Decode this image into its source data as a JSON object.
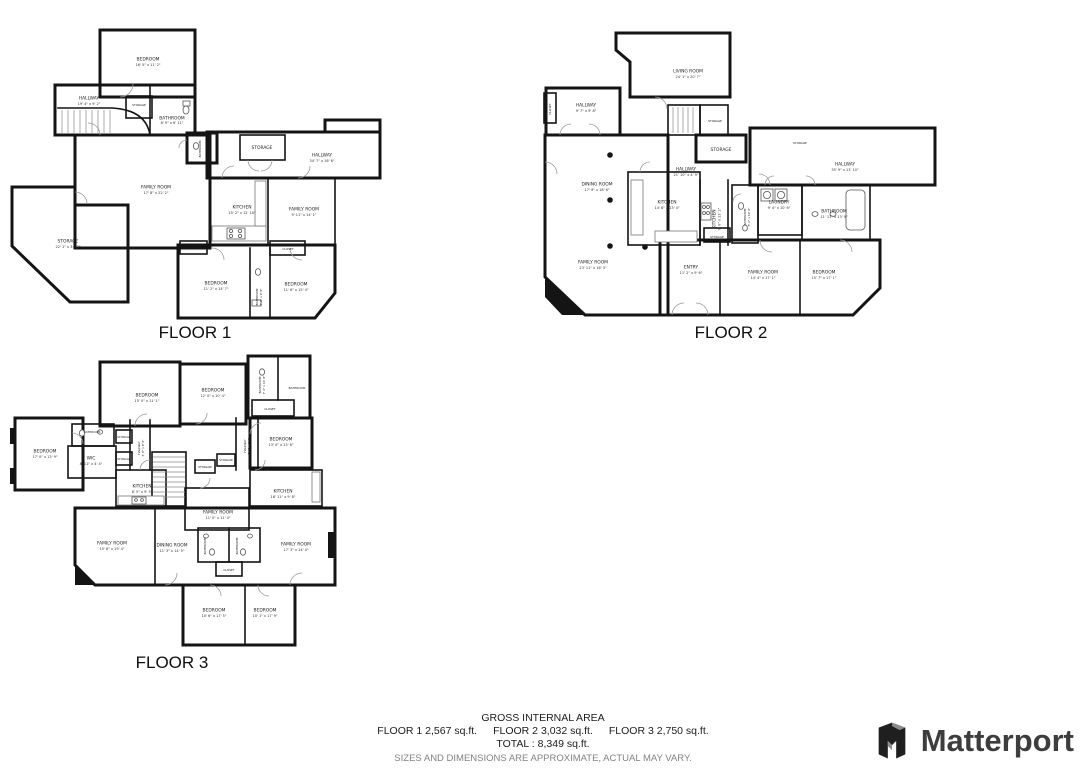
{
  "colors": {
    "walls": "#141414",
    "label_text": "#1d1d1d",
    "disclaimer_gray": "#828282",
    "logo_gray": "#3d3d3d"
  },
  "floors": [
    {
      "label": "FLOOR 1",
      "rooms": [
        {
          "name": "BEDROOM",
          "dims": "16' 5\" x 11' 2\""
        },
        {
          "name": "HALLWAY",
          "dims": "19' 4\" x 9' 2\""
        },
        {
          "name": "STORAGE",
          "dims": ""
        },
        {
          "name": "BATHROOM",
          "dims": "8' 9\" x 6' 11\""
        },
        {
          "name": "BATHROOM",
          "dims": ""
        },
        {
          "name": "STORAGE",
          "dims": ""
        },
        {
          "name": "HALLWAY",
          "dims": "34' 7\" x 16' 6\""
        },
        {
          "name": "FAMILY ROOM",
          "dims": "17' 8\" x 22' 2\""
        },
        {
          "name": "KITCHEN",
          "dims": "15' 2\" x 12' 10\""
        },
        {
          "name": "FAMILY ROOM",
          "dims": "9' 11\" x 14' 1\""
        },
        {
          "name": "STORAGE",
          "dims": "22' 1\" x 34' 3\""
        },
        {
          "name": "CLOSET",
          "dims": ""
        },
        {
          "name": "CLOSET",
          "dims": ""
        },
        {
          "name": "BEDROOM",
          "dims": "11' 2\" x 14' 7\""
        },
        {
          "name": "BATHROOM",
          "dims": "4' 2\" x 9' 9\""
        },
        {
          "name": "BEDROOM",
          "dims": "11' 6\" x 15' 4\""
        }
      ]
    },
    {
      "label": "FLOOR 2",
      "rooms": [
        {
          "name": "LIVING ROOM",
          "dims": "24' 1\" x 20' 7\""
        },
        {
          "name": "HALLWAY",
          "dims": "9' 7\" x 9' 8\""
        },
        {
          "name": "CLOSET",
          "dims": ""
        },
        {
          "name": "STORAGE",
          "dims": ""
        },
        {
          "name": "STORAGE",
          "dims": ""
        },
        {
          "name": "STORAGE",
          "dims": ""
        },
        {
          "name": "HALLWAY",
          "dims": "21' 10\" x 4' 9\""
        },
        {
          "name": "HALLWAY",
          "dims": "35' 9\" x 13' 10\""
        },
        {
          "name": "DINING ROOM",
          "dims": "17' 9\" x 18' 6\""
        },
        {
          "name": "KITCHEN",
          "dims": "14' 8\" x 13' 4\""
        },
        {
          "name": "KITCHEN",
          "dims": "7' 0\" x 13' 2\""
        },
        {
          "name": "BATHROOM",
          "dims": "5' 2\" x 10' 6\""
        },
        {
          "name": "LAUNDRY",
          "dims": "9' 4\" x 10' 6\""
        },
        {
          "name": "BATHROOM",
          "dims": "11' 11\" x 13' 9\""
        },
        {
          "name": "FAMILY ROOM",
          "dims": "23' 11\" x 16' 3\""
        },
        {
          "name": "ENTRY",
          "dims": "11' 2\" x 9' 6\""
        },
        {
          "name": "STORAGE",
          "dims": ""
        },
        {
          "name": "FAMILY ROOM",
          "dims": "14' 4\" x 17' 1\""
        },
        {
          "name": "BEDROOM",
          "dims": "15' 7\" x 17' 1\""
        }
      ]
    },
    {
      "label": "FLOOR 3",
      "rooms": [
        {
          "name": "BEDROOM",
          "dims": "15' 0\" x 11' 1\""
        },
        {
          "name": "BEDROOM",
          "dims": "12' 0\" x 10' 4\""
        },
        {
          "name": "BATHROOM",
          "dims": "7' 4\" x 10' 8\""
        },
        {
          "name": "BATHROOM",
          "dims": ""
        },
        {
          "name": "CLOSET",
          "dims": ""
        },
        {
          "name": "BEDROOM",
          "dims": "13' 0\" x 13' 6\""
        },
        {
          "name": "BEDROOM",
          "dims": "17' 0\" x 13' 9\""
        },
        {
          "name": "WIC",
          "dims": "8' 11\" x 4' 4\""
        },
        {
          "name": "BATHROOM",
          "dims": ""
        },
        {
          "name": "HALLWAY",
          "dims": "3' 8\" x 9' 6\""
        },
        {
          "name": "STORAGE",
          "dims": ""
        },
        {
          "name": "STORAGE",
          "dims": ""
        },
        {
          "name": "HALLWAY",
          "dims": "7' 2\" x 8' 8\""
        },
        {
          "name": "STORAGE",
          "dims": ""
        },
        {
          "name": "STORAGE",
          "dims": ""
        },
        {
          "name": "KITCHEN",
          "dims": "8' 5\" x 9' 5\""
        },
        {
          "name": "KITCHEN",
          "dims": "16' 11\" x 9' 8\""
        },
        {
          "name": "FAMILY ROOM",
          "dims": "11' 0\" x 11' 4\""
        },
        {
          "name": "FAMILY ROOM",
          "dims": "15' 8\" x 19' 4\""
        },
        {
          "name": "DINING ROOM",
          "dims": "11' 3\" x 14' 5\""
        },
        {
          "name": "BATHROOM",
          "dims": ""
        },
        {
          "name": "BATHROOM",
          "dims": ""
        },
        {
          "name": "CLOSET",
          "dims": ""
        },
        {
          "name": "FAMILY ROOM",
          "dims": "17' 3\" x 14' 4\""
        },
        {
          "name": "BEDROOM",
          "dims": "10' 6\" x 17' 5\""
        },
        {
          "name": "BEDROOM",
          "dims": "10' 1\" x 17' 9\""
        }
      ]
    }
  ],
  "footer": {
    "title": "GROSS INTERNAL AREA",
    "floor1_area": "FLOOR 1 2,567 sq.ft.",
    "floor2_area": "FLOOR 2 3,032 sq.ft.",
    "floor3_area": "FLOOR 3 2,750 sq.ft.",
    "total": "TOTAL :  8,349 sq.ft.",
    "disclaimer": "SIZES AND DIMENSIONS ARE APPROXIMATE, ACTUAL MAY VARY."
  },
  "logo": {
    "brand": "Matterport"
  }
}
